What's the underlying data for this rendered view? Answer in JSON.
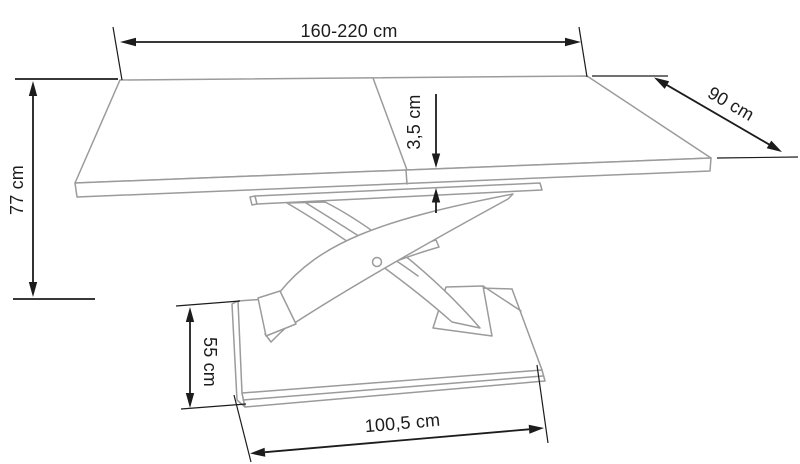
{
  "diagram": {
    "colors": {
      "drawing": "#9b9b9b",
      "dimension": "#1c1c1c"
    },
    "dimensions": {
      "tabletop_width": "160-220 cm",
      "tabletop_depth": "90 cm",
      "table_height": "77 cm",
      "tabletop_thickness": "3,5 cm",
      "base_depth": "55 cm",
      "base_width": "100,5 cm"
    }
  }
}
